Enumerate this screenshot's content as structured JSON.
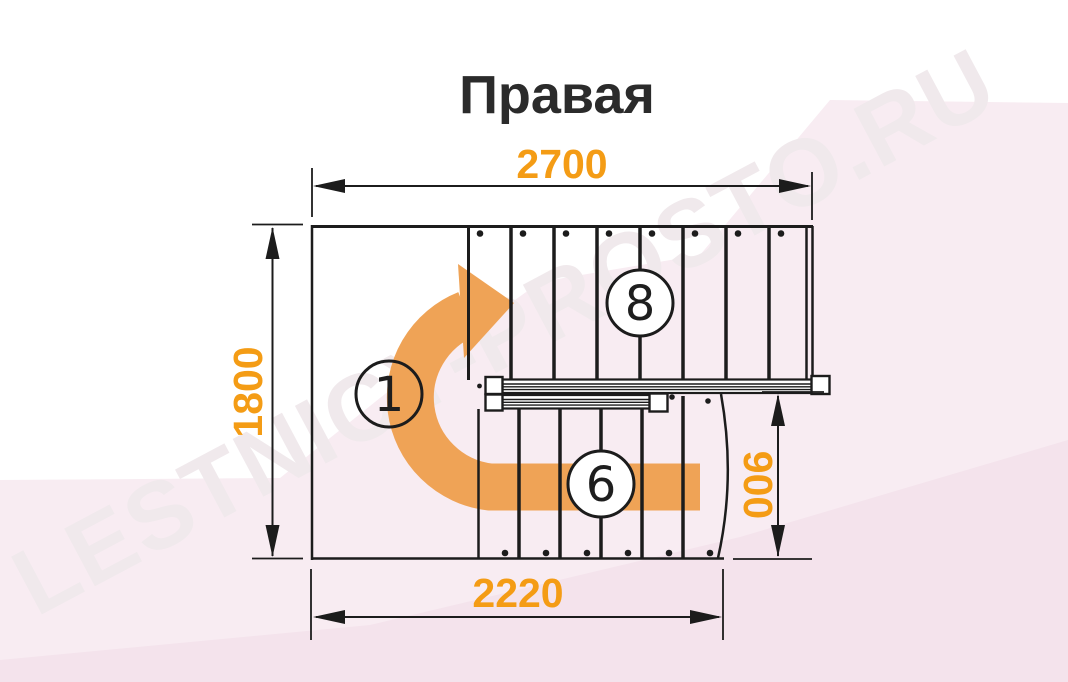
{
  "title": "Правая",
  "watermark": {
    "text": "LESTNICY-PROSTO.RU"
  },
  "colors": {
    "dimension": "#f49c15",
    "arrow": "#efa356",
    "line": "#1c1c1c",
    "background_tint": "#f8ecf2",
    "background_tint_deep": "#f4e3ec",
    "watermark": "#f0e9ec",
    "title": "#2b2b2b"
  },
  "dimensions": {
    "top_width": "2700",
    "left_height": "1800",
    "right_height": "900",
    "bottom_width": "2220"
  },
  "flights": {
    "upper": {
      "label": "8",
      "treads": 8
    },
    "landing": {
      "label": "1"
    },
    "lower": {
      "label": "6",
      "treads": 6
    }
  }
}
